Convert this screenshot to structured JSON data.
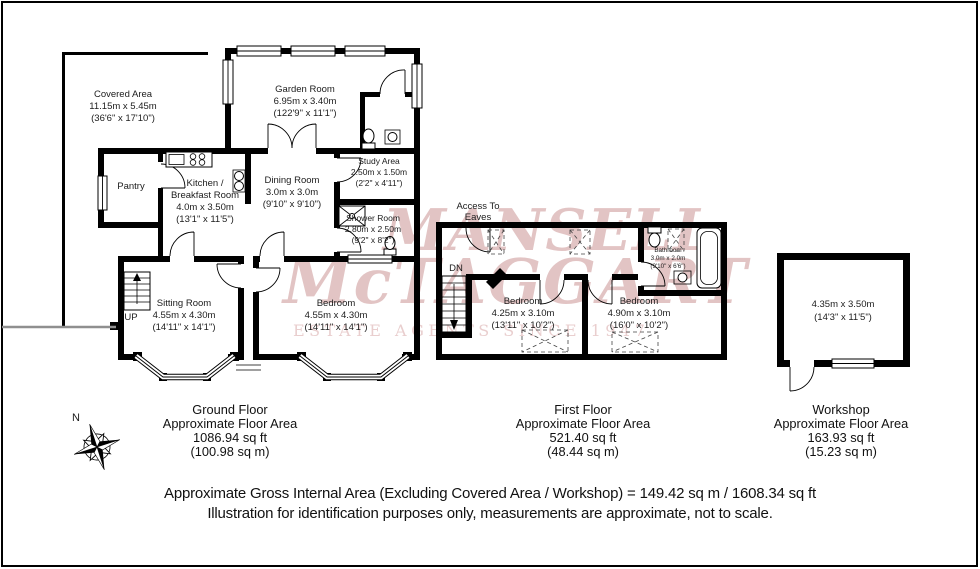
{
  "watermark": {
    "line1": "MANSELL",
    "line2": "McTAGGART",
    "line3": "ESTATE AGENTS SINCE 1947",
    "color": "#bb7373"
  },
  "compass": {
    "north_label": "N"
  },
  "ground_floor": {
    "caption": {
      "title": "Ground Floor",
      "subtitle": "Approximate Floor Area",
      "area_sqft": "1086.94 sq ft",
      "area_sqm": "(100.98 sq m)"
    },
    "rooms": {
      "covered_area": {
        "name": "Covered Area",
        "metric": "11.15m x 5.45m",
        "imperial": "(36'6\" x 17'10\")"
      },
      "garden_room": {
        "name": "Garden Room",
        "metric": "6.95m x 3.40m",
        "imperial": "(122'9\" x 11'1\")"
      },
      "pantry": {
        "name": "Pantry"
      },
      "kitchen_breakfast": {
        "name_line1": "Kitchen /",
        "name_line2": "Breakfast Room",
        "metric": "4.0m x 3.50m",
        "imperial": "(13'1\" x 11'5\")"
      },
      "dining_room": {
        "name": "Dining Room",
        "metric": "3.0m x 3.0m",
        "imperial": "(9'10\" x 9'10\")"
      },
      "study_area": {
        "name": "Study Area",
        "metric": "2.50m x 1.50m",
        "imperial": "(2'2\" x 4'11\")"
      },
      "shower_room": {
        "name": "Shower Room",
        "metric": "2.80m x 2.50m",
        "imperial": "(9'2\" x 8'2\")"
      },
      "sitting_room": {
        "name": "Sitting Room",
        "metric": "4.55m x 4.30m",
        "imperial": "(14'11\" x 14'1\")"
      },
      "bedroom": {
        "name": "Bedroom",
        "metric": "4.55m x 4.30m",
        "imperial": "(14'11\" x 14'1\")"
      },
      "stairs_label": "UP"
    }
  },
  "first_floor": {
    "caption": {
      "title": "First Floor",
      "subtitle": "Approximate Floor Area",
      "area_sqft": "521.40 sq ft",
      "area_sqm": "(48.44 sq m)"
    },
    "rooms": {
      "access_to_eaves": {
        "line1": "Access To",
        "line2": "Eaves"
      },
      "stairs_label": "DN",
      "bedroom_left": {
        "name": "Bedroom",
        "metric": "4.25m x 3.10m",
        "imperial": "(13'11\" x 10'2\")"
      },
      "bedroom_right": {
        "name": "Bedroom",
        "metric": "4.90m x 3.10m",
        "imperial": "(16'0\" x 10'2\")"
      },
      "bathroom": {
        "name": "Bathroom",
        "metric": "3.0m x 2.0m",
        "imperial": "(9'10\" x 6'6\")"
      }
    }
  },
  "workshop": {
    "caption": {
      "title": "Workshop",
      "subtitle": "Approximate Floor Area",
      "area_sqft": "163.93 sq ft",
      "area_sqm": "(15.23 sq m)"
    },
    "room": {
      "metric": "4.35m x 3.50m",
      "imperial": "(14'3\" x 11'5\")"
    }
  },
  "footer": {
    "line1": "Approximate Gross Internal Area (Excluding Covered Area / Workshop) = 149.42 sq m / 1608.34 sq ft",
    "line2": "Illustration for identification purposes only, measurements are approximate, not to scale."
  }
}
